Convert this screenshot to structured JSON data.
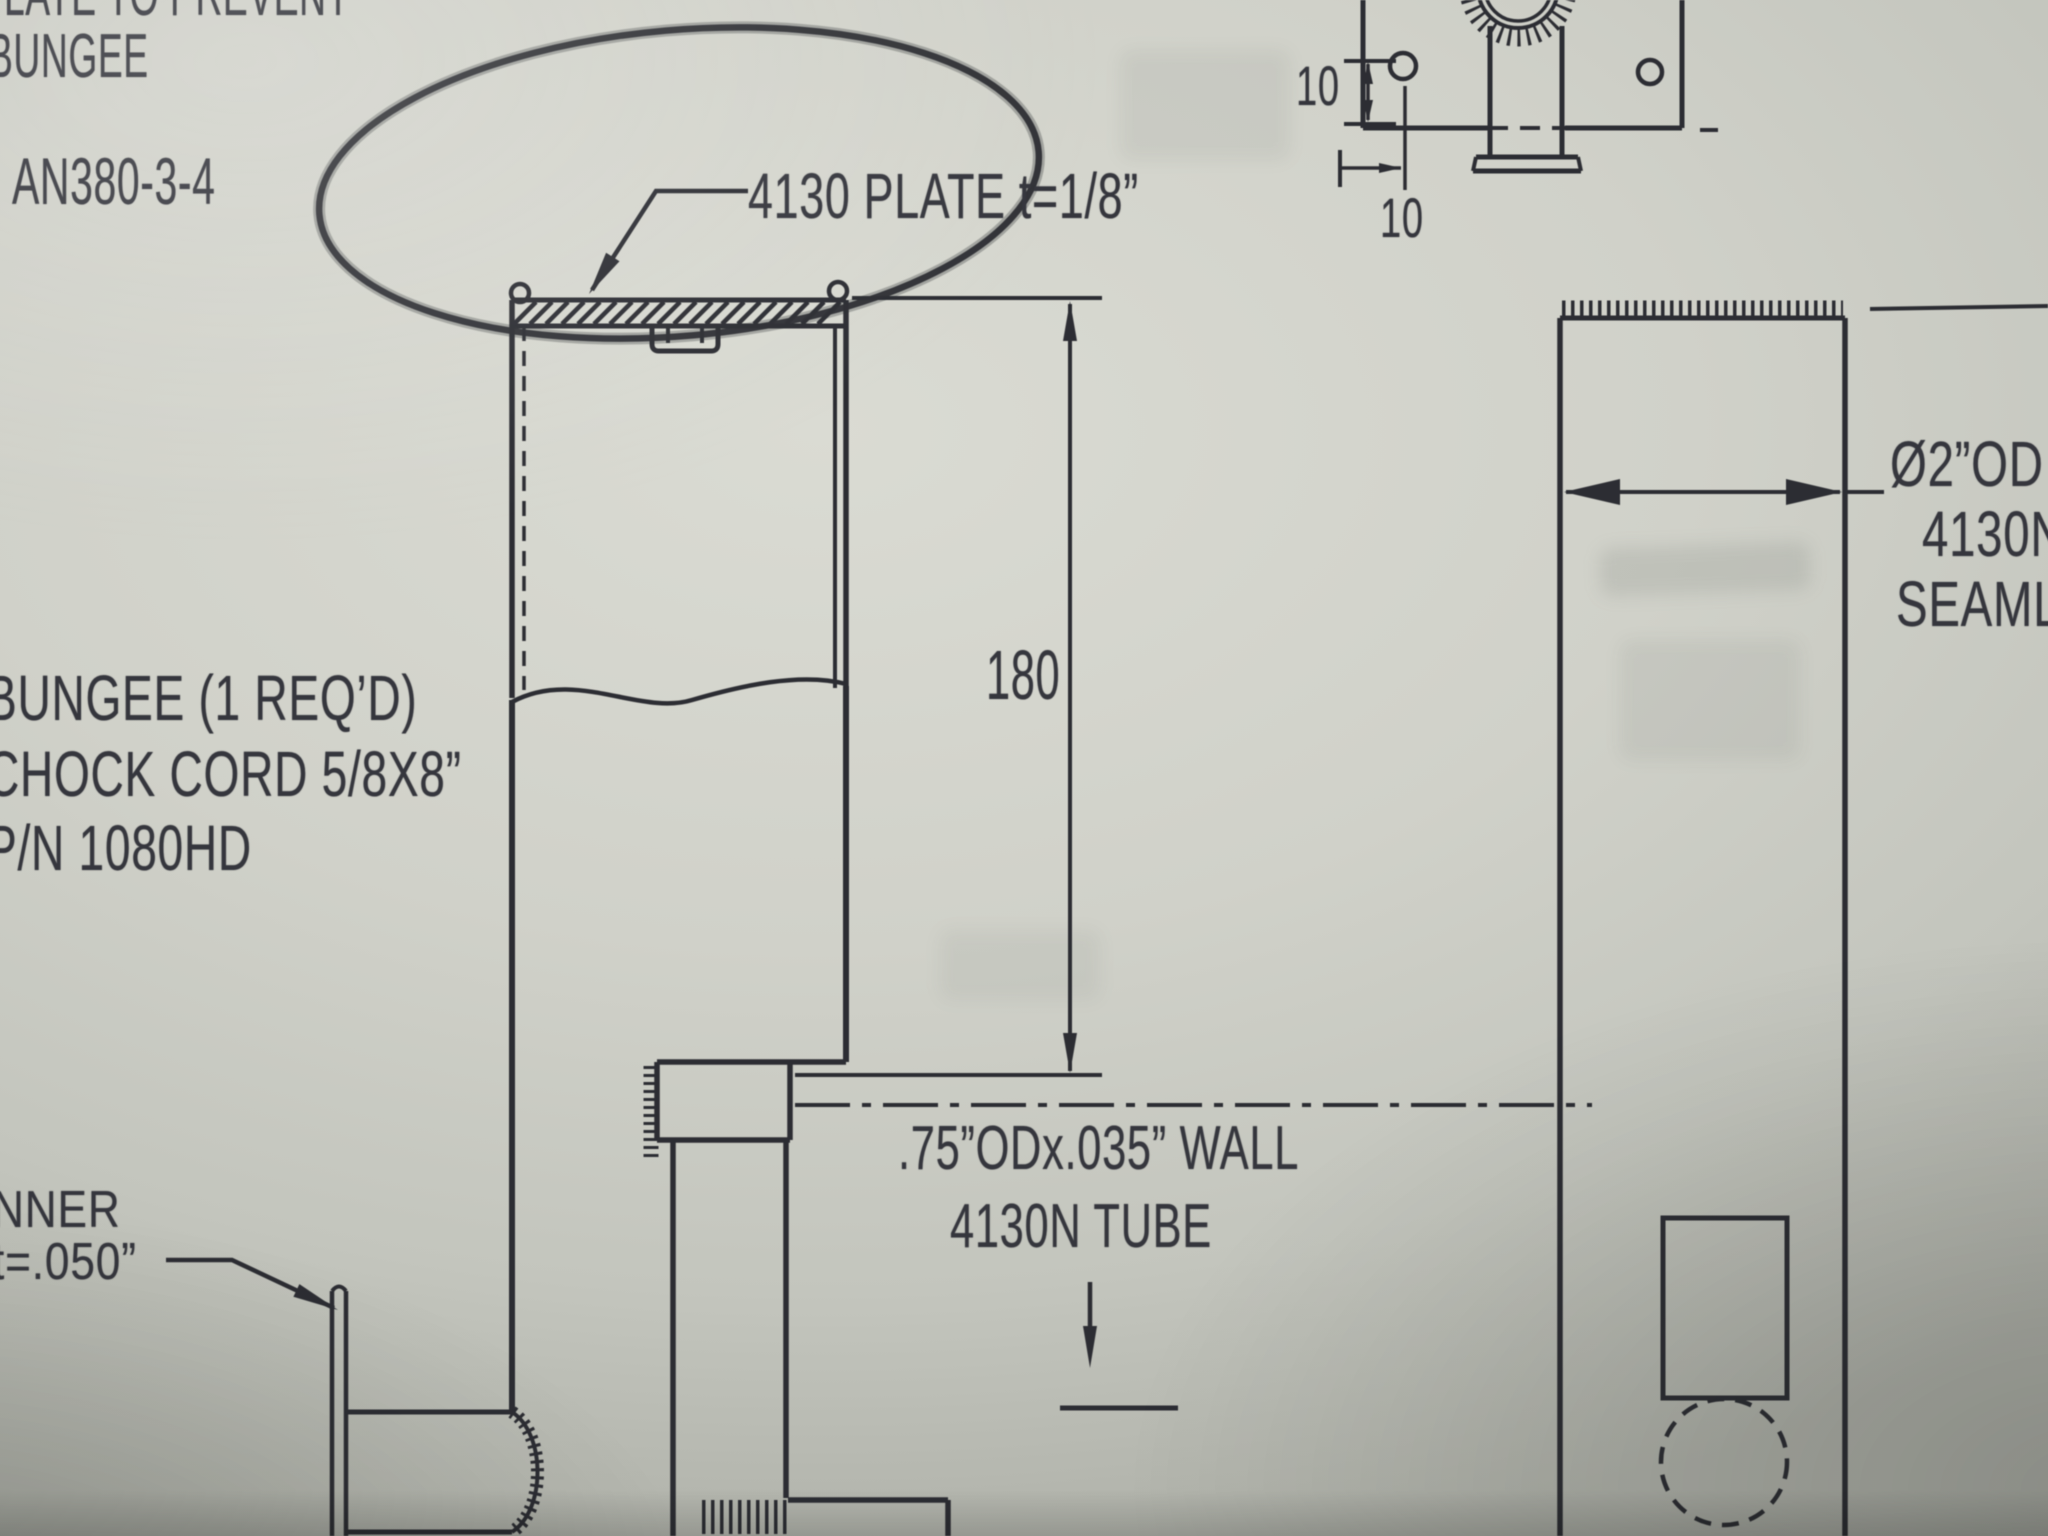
{
  "drawing": {
    "top_left_note": {
      "line1": "LATE TO PREVENT",
      "line2": "BUNGEE"
    },
    "fastener_callout": "AN380-3-4",
    "plate_callout": "4130 PLATE t=1/8”",
    "bungee_callout": {
      "line1": "BUNGEE (1 REQ’D)",
      "line2": "CHOCK CORD 5/8X8”",
      "line3": "P/N 1080HD"
    },
    "liner_callout": {
      "line1": "NNER",
      "line2": "t=.050”"
    },
    "inner_tube_callout": {
      "line1": ".75”ODx.035” WALL",
      "line2": "4130N TUBE"
    },
    "outer_tube_callout": {
      "line1": "Ø2”OD",
      "line2": "4130N",
      "line3": "SEAMLE"
    },
    "dimensions": {
      "strut_length": "180",
      "hole_edge_vertical": "10",
      "hole_edge_horizontal": "10"
    },
    "highlight": {
      "color": "#d91510"
    }
  }
}
